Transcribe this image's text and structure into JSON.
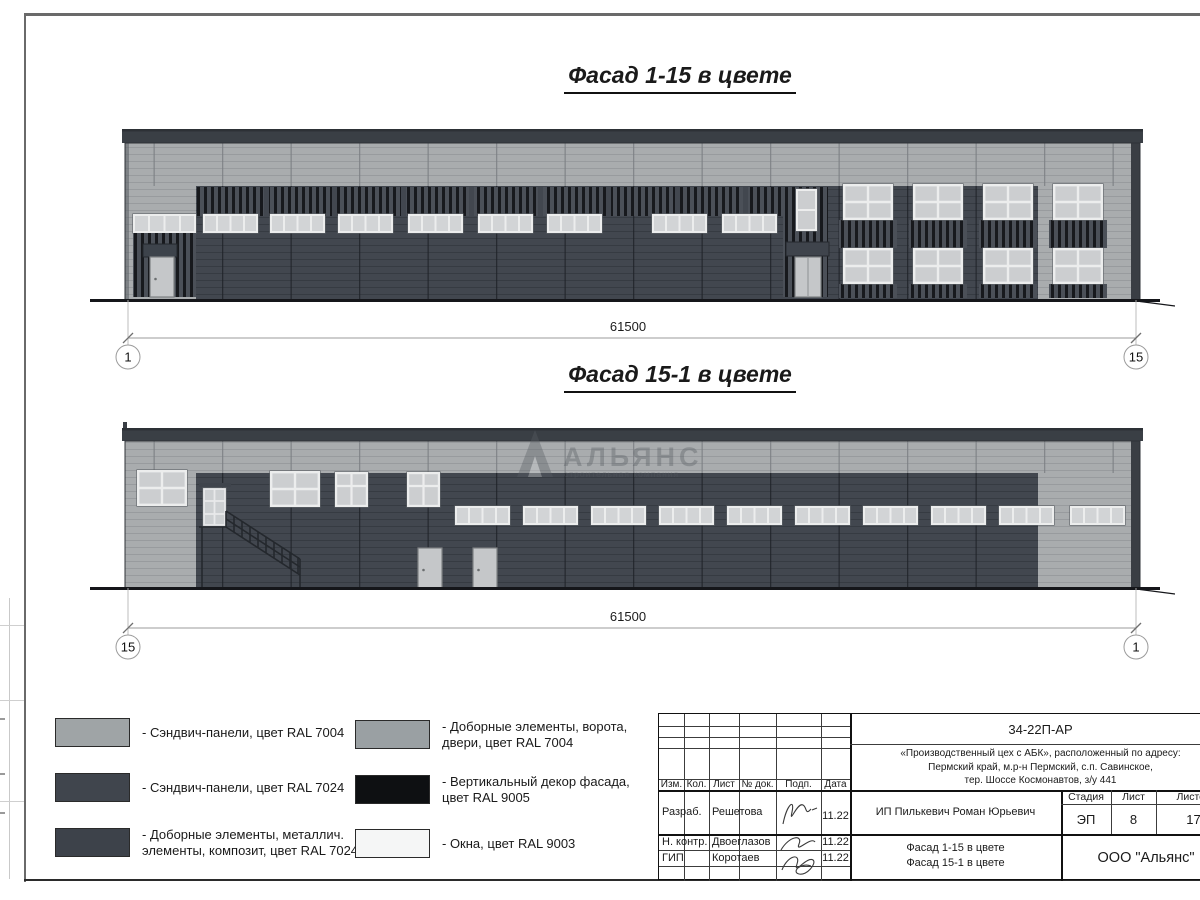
{
  "sheet": {
    "facade_1_15": {
      "title": "Фасад 1-15 в цвете",
      "dimension": "61500",
      "axis_left": "1",
      "axis_right": "15"
    },
    "facade_15_1": {
      "title": "Фасад 15-1 в цвете",
      "dimension": "61500",
      "axis_left": "15",
      "axis_right": "1"
    }
  },
  "watermark": {
    "name": "АЛЬЯНС",
    "tagline": "строительная компания"
  },
  "palette": {
    "panels_light_ral7004": "#a9acae",
    "panels_dark_ral7024": "#42474f",
    "decor_ral9005": "#17191d",
    "windows_ral9003": "#d2d4d6"
  },
  "legend": [
    {
      "color": "#9fa4a6",
      "label": "- Сэндвич-панели, цвет RAL 7004"
    },
    {
      "color": "#40454d",
      "label": "- Сэндвич-панели, цвет RAL 7024"
    },
    {
      "color": "#3d424a",
      "label": "- Доборные элементы, металлич.\nэлементы, композит, цвет RAL 7024"
    },
    {
      "color": "#9aa0a3",
      "label": "- Доборные элементы, ворота,\nдвери, цвет RAL 7004"
    },
    {
      "color": "#0e1012",
      "label": "- Вертикальный декор фасада,\nцвет RAL 9005"
    },
    {
      "color": "#f5f6f6",
      "label": "- Окна, цвет RAL 9003"
    }
  ],
  "title_block": {
    "doc_number": "34-22П-АР",
    "project_lines": [
      "«Производственный цех с АБК», расположенный по адресу:",
      "Пермский край, м.р-н Пермский, с.п. Савинское,",
      "тер. Шоссе Космонавтов, з/у 441"
    ],
    "rev_columns": [
      "Изм.",
      "Кол.",
      "Лист",
      "№ док.",
      "Подп.",
      "Дата"
    ],
    "staff": [
      {
        "role": "Разраб.",
        "name": "Решетова",
        "date": "11.22"
      },
      {
        "role": "Н. контр.",
        "name": "Двоеглазов",
        "date": "11.22"
      },
      {
        "role": "ГИП",
        "name": "Коротаев",
        "date": "11.22"
      }
    ],
    "client": "ИП Пилькевич Роман Юрьевич",
    "stage_label": "Стадия",
    "sheet_label": "Лист",
    "sheets_label": "Листов",
    "stage": "ЭП",
    "sheet_no": "8",
    "sheets_total": "17",
    "sheet_title_lines": [
      "Фасад 1-15 в цвете",
      "Фасад 15-1 в цвете"
    ],
    "company": "ООО \"Альянс\""
  }
}
